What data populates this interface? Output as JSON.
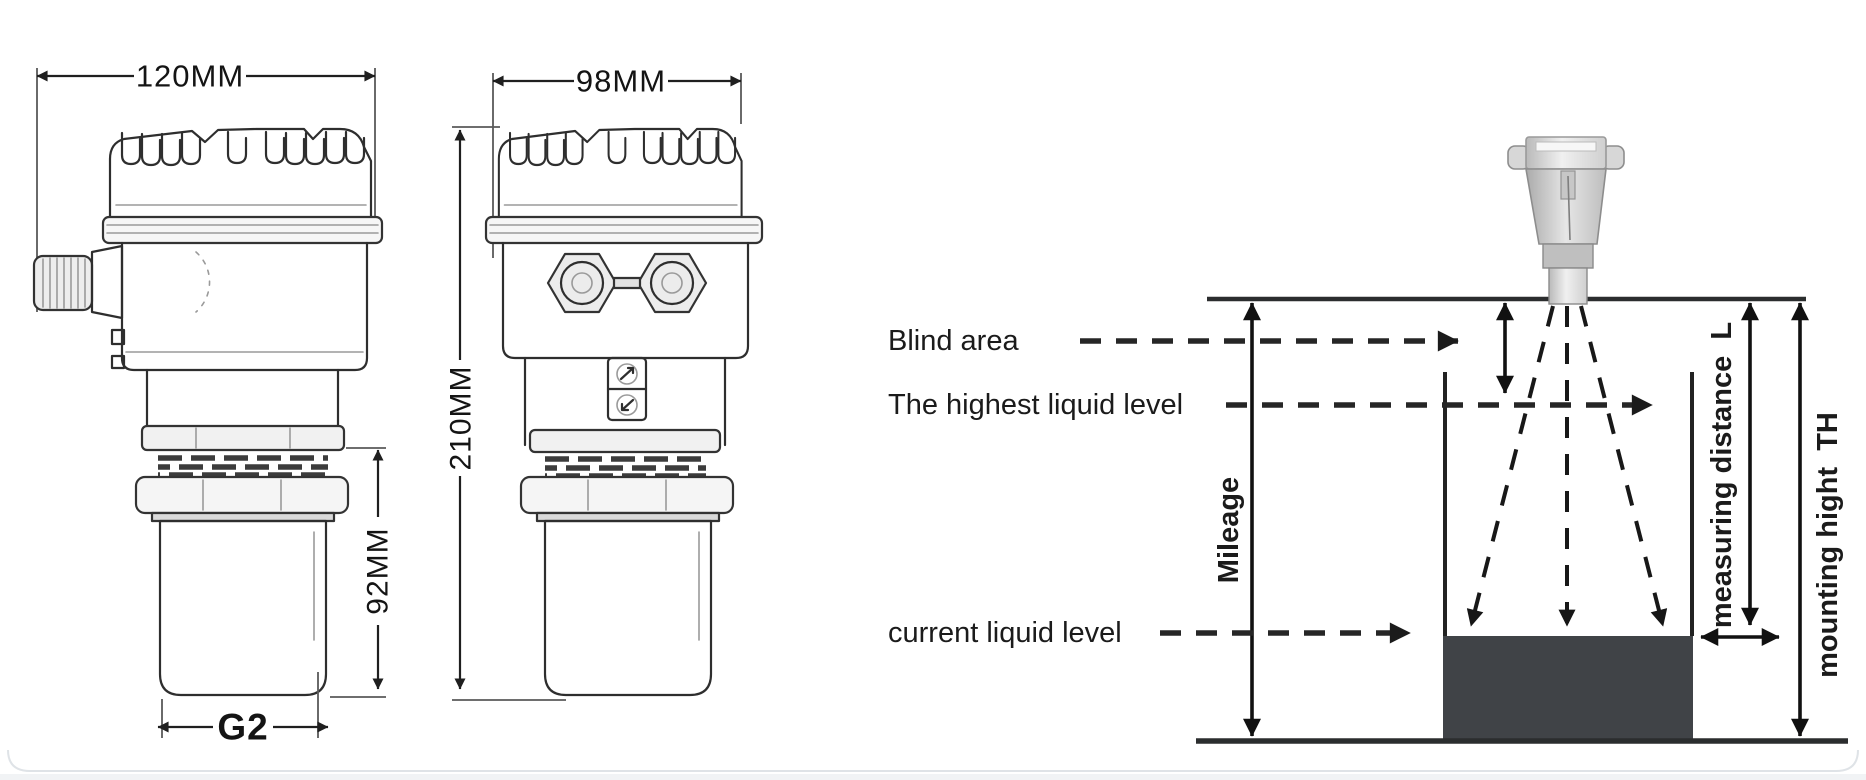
{
  "left_view": {
    "width_dim": "120MM",
    "transducer_height_dim": "92MM",
    "thread_dim": "G2"
  },
  "front_view": {
    "width_dim": "98MM",
    "height_dim": "210MM"
  },
  "schematic": {
    "blind_area_label": "Blind area",
    "highest_level_label": "The highest liquid level",
    "current_level_label": "current liquid level",
    "mileage_label": "Mileage",
    "measuring_distance_label": "measuring distance  L",
    "mounting_height_label": "mounting hight  TH",
    "colors": {
      "liquid_fill": "#404347",
      "line": "#1d1d1d"
    }
  }
}
